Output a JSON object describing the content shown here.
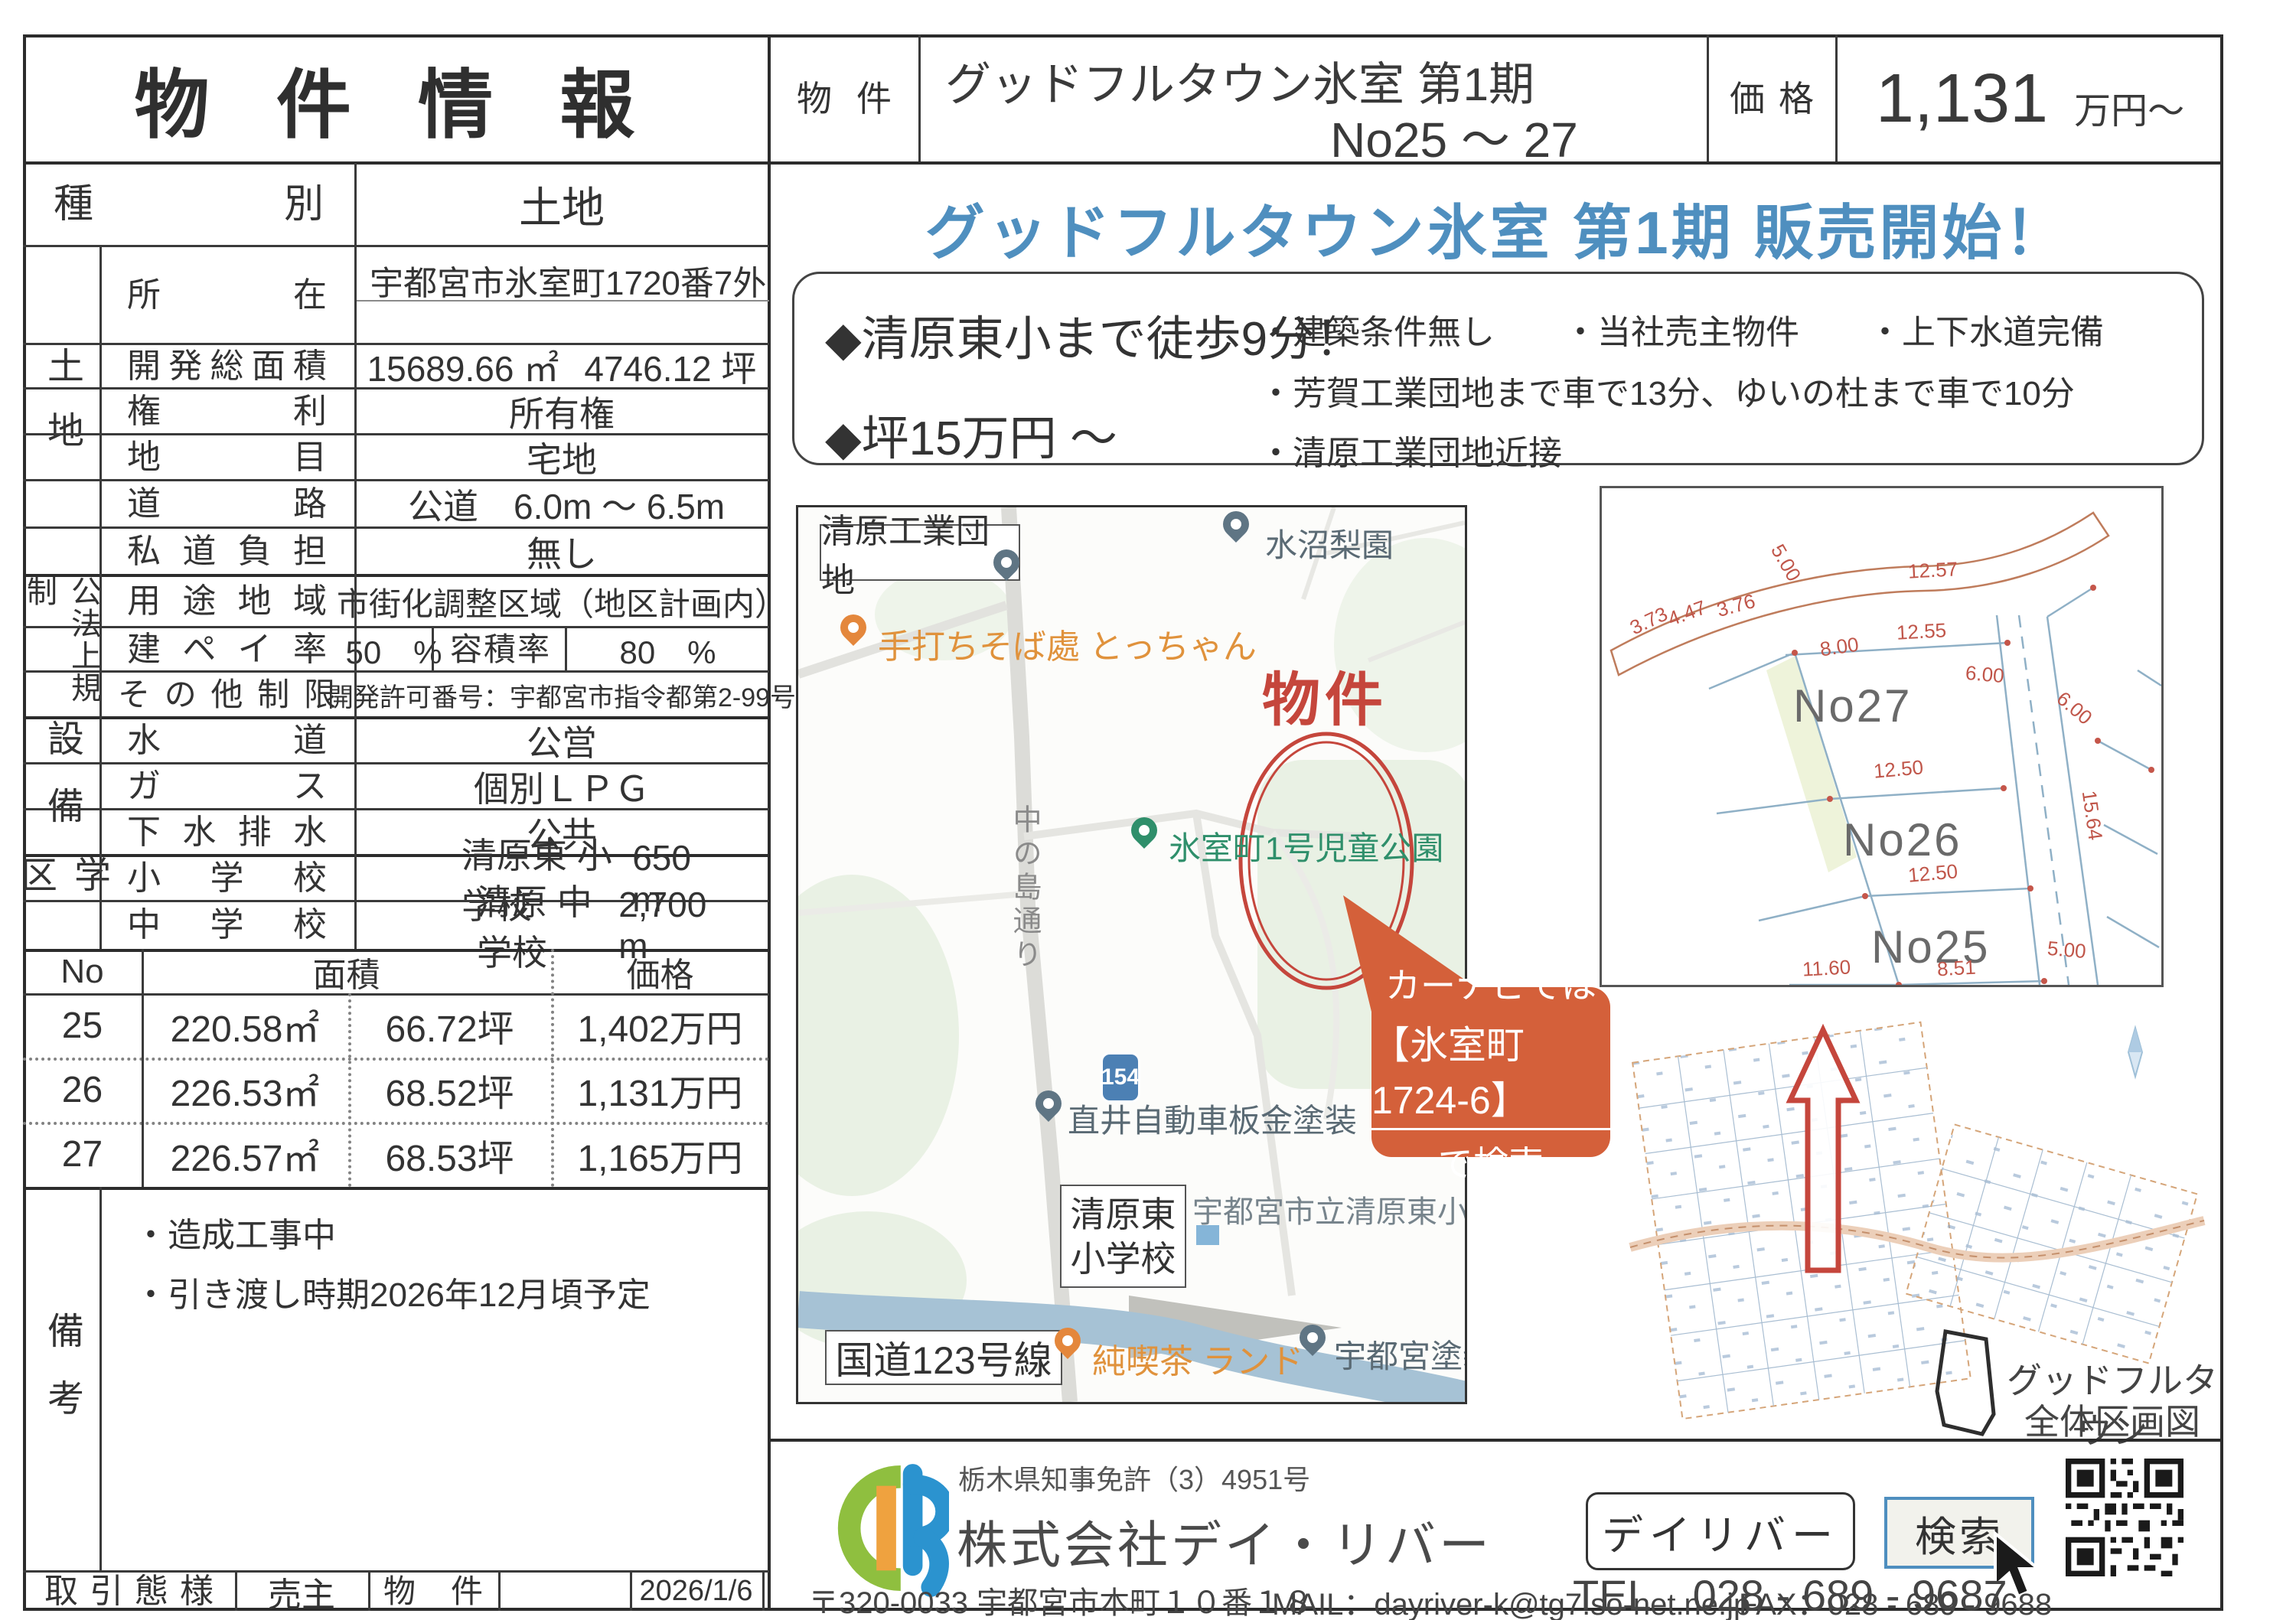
{
  "header": {
    "title": "物 件 情 報",
    "name_label": "物件名",
    "name_line1": "グッドフルタウン氷室 第1期",
    "name_line2": "No25 ～ 27",
    "price_label": "価格",
    "price_value": "1,131",
    "price_unit": "万円～"
  },
  "shubetsu": {
    "label": "種別",
    "value": "土地"
  },
  "groups": {
    "tochi": "土地",
    "koho": "公法上規制",
    "setsubi": "設備",
    "gakku": "学区",
    "biko": "備考"
  },
  "rows": {
    "shozai": {
      "label": "所在",
      "value": "宇都宮市氷室町1720番7外"
    },
    "kaihatsu": {
      "label": "開発総面積",
      "v1": "15689.66 ㎡",
      "v2": "4746.12 坪"
    },
    "kenri": {
      "label": "権利",
      "value": "所有権"
    },
    "chimoku": {
      "label": "地目",
      "value": "宅地"
    },
    "doro": {
      "label": "道路",
      "value": "公道　6.0m ～ 6.5m"
    },
    "shido": {
      "label": "私道負担",
      "value": "無し"
    },
    "yoto": {
      "label": "用途地域",
      "value": "市街化調整区域（地区計画内）"
    },
    "kenpei": {
      "label": "建ペイ率",
      "value": "50　%",
      "label2": "容積率",
      "value2": "80　%"
    },
    "sonota": {
      "label": "その他制限",
      "value": "開発許可番号：宇都宮市指令都第2-99号"
    },
    "suido": {
      "label": "水道",
      "value": "公営"
    },
    "gas": {
      "label": "ガス",
      "value": "個別ＬＰＧ"
    },
    "gesui": {
      "label": "下水排水",
      "value": "公共"
    },
    "shogakko": {
      "label": "小学校",
      "name": "清原東 小学校",
      "dist": "650 m"
    },
    "chugakko": {
      "label": "中学校",
      "name": "清原 中学校",
      "dist": "2,700 m"
    }
  },
  "lots": {
    "headers": {
      "no": "No",
      "area": "面積",
      "price": "価格"
    },
    "rows": [
      {
        "no": "25",
        "sqm": "220.58㎡",
        "tsubo": "66.72坪",
        "price": "1,402万円"
      },
      {
        "no": "26",
        "sqm": "226.53㎡",
        "tsubo": "68.52坪",
        "price": "1,131万円"
      },
      {
        "no": "27",
        "sqm": "226.57㎡",
        "tsubo": "68.53坪",
        "price": "1,165万円"
      }
    ]
  },
  "biko": {
    "item1": "・造成工事中",
    "item2": "・引き渡し時期2026年12月頃予定"
  },
  "bottom": {
    "torihiki_label": "取引態様",
    "torihiki_value": "売主",
    "bukken_no_label": "物件 NO",
    "date": "2026/1/6"
  },
  "promo": {
    "headline": "グッドフルタウン氷室 第1期 販売開始！",
    "point1": "◆清原東小まで徒歩9分！",
    "point2": "◆坪15万円 ～",
    "bullet1a": "・建築条件無し",
    "bullet1b": "・当社売主物件",
    "bullet1c": "・上下水道完備",
    "bullet2": "・芳賀工業団地まで車で13分、ゆいの杜まで車で10分",
    "bullet3": "・清原工業団地近接"
  },
  "map": {
    "industrial": "清原工業団地",
    "pear": "水沼梨園",
    "soba": "手打ちそば處 とっちゃん",
    "bukken": "物件",
    "park": "氷室町1号児童公園",
    "road_name": "中の島通り",
    "body_shop": "直井自動車板金塗装",
    "route_shield": "154",
    "school_line1": "清原東",
    "school_line2": "小学校",
    "school_official": "宇都宮市立清原東小",
    "kokudo": "国道123号線",
    "cafe": "純喫茶 ランド",
    "paint": "宇都宮塗装",
    "navi_line1": "カーナビでは",
    "navi_line2": "【氷室町1724-6】",
    "navi_line3": "で検索"
  },
  "diagram": {
    "no27": "No27",
    "no26": "No26",
    "no25": "No25",
    "dims": [
      "12.57",
      "3.73",
      "4.47",
      "3.76",
      "5.00",
      "8.00",
      "12.55",
      "6.00",
      "6.00",
      "12.50",
      "12.50",
      "15.64",
      "8.51",
      "11.60",
      "5.00"
    ]
  },
  "zentai": {
    "line1": "グッドフルタウン",
    "line2": "全体区画図"
  },
  "footer": {
    "license": "栃木県知事免許（3）4951号",
    "company": "株式会社デイ・リバー",
    "brand_box": "デイリバー",
    "search_btn": "検索",
    "tel": "TEL　028 - 689 - 9687",
    "address": "〒320-0033 宇都宮市本町１０番１８",
    "mail": "MAIL：dayriver-k@tg7.so-net.ne.jp",
    "fax": "FAX：028 - 689 - 9688"
  },
  "colors": {
    "headline_blue": "#4f8fbf",
    "accent_red": "#c5463c",
    "callout_orange": "#d4603a",
    "logo_green": "#8fbf3f",
    "logo_blue": "#2b93cf",
    "logo_orange": "#efa23f"
  }
}
